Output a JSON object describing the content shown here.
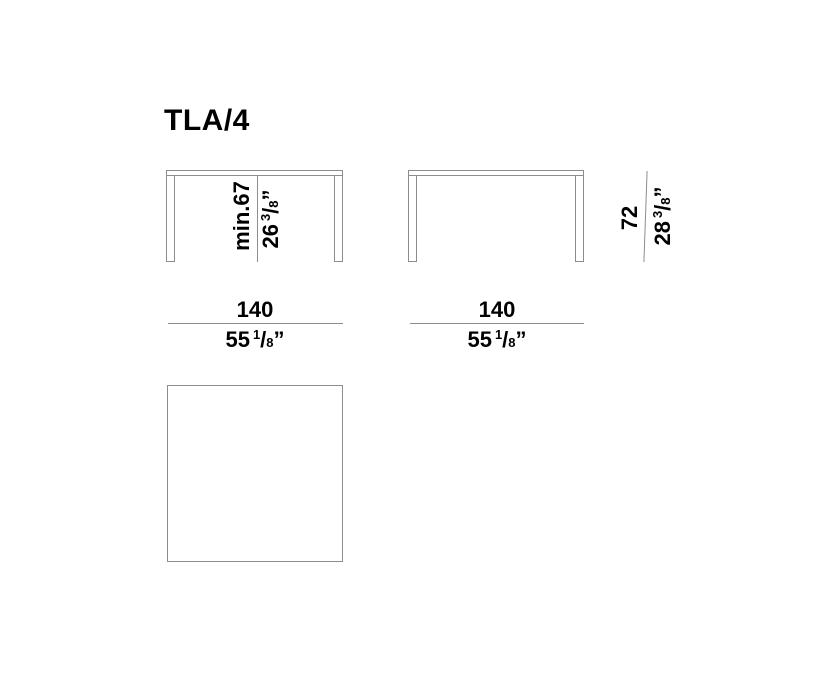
{
  "title": "TLA/4",
  "colors": {
    "line": "#8d8d8d",
    "text": "#000000",
    "background": "#ffffff"
  },
  "front_view_a": {
    "height_metric": "min.67",
    "height_imperial": {
      "whole": "26",
      "numerator": "3",
      "slash": "/",
      "denominator": "8",
      "inch_mark": "”"
    },
    "width_metric": "140",
    "width_imperial": {
      "whole": "55",
      "numerator": "1",
      "slash": "/",
      "denominator": "8",
      "inch_mark": "”"
    }
  },
  "front_view_b": {
    "height_metric": "72",
    "height_imperial": {
      "whole": "28",
      "numerator": "3",
      "slash": "/",
      "denominator": "8",
      "inch_mark": "”"
    },
    "width_metric": "140",
    "width_imperial": {
      "whole": "55",
      "numerator": "1",
      "slash": "/",
      "denominator": "8",
      "inch_mark": "”"
    }
  }
}
